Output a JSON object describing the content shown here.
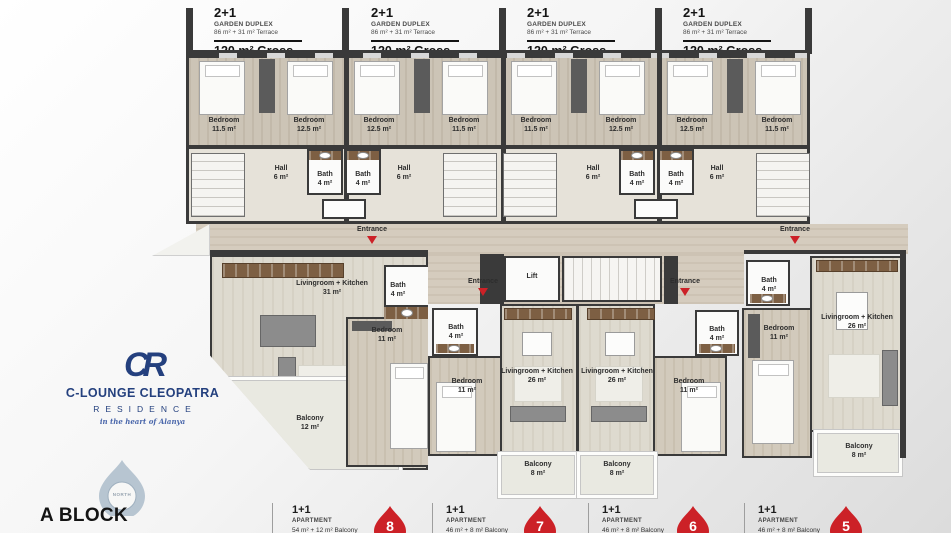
{
  "colors": {
    "red": "#cc2127",
    "blue": "#24407e",
    "wall": "#3a3a3a"
  },
  "headers": [
    {
      "type": "2+1",
      "category": "GARDEN DUPLEX",
      "area": "86 m² + 31 m² Terrace",
      "gross": "120 m² Gross"
    },
    {
      "type": "2+1",
      "category": "GARDEN DUPLEX",
      "area": "86 m² + 31 m² Terrace",
      "gross": "120 m² Gross"
    },
    {
      "type": "2+1",
      "category": "GARDEN DUPLEX",
      "area": "86 m² + 31 m² Terrace",
      "gross": "120 m² Gross"
    },
    {
      "type": "2+1",
      "category": "GARDEN DUPLEX",
      "area": "86 m² + 31 m² Terrace",
      "gross": "120 m² Gross"
    }
  ],
  "upper": {
    "bedrooms": [
      {
        "name": "Bedroom",
        "area": "11.5 m²"
      },
      {
        "name": "Bedroom",
        "area": "12.5 m²"
      },
      {
        "name": "Bedroom",
        "area": "12.5 m²"
      },
      {
        "name": "Bedroom",
        "area": "11.5 m²"
      },
      {
        "name": "Bedroom",
        "area": "11.5 m²"
      },
      {
        "name": "Bedroom",
        "area": "12.5 m²"
      },
      {
        "name": "Bedroom",
        "area": "12.5 m²"
      },
      {
        "name": "Bedroom",
        "area": "11.5 m²"
      }
    ],
    "halls": [
      {
        "name": "Hall",
        "area": "6 m²"
      },
      {
        "name": "Hall",
        "area": "6 m²"
      },
      {
        "name": "Hall",
        "area": "6 m²"
      },
      {
        "name": "Hall",
        "area": "6 m²"
      }
    ],
    "baths": [
      {
        "name": "Bath",
        "area": "4 m²"
      },
      {
        "name": "Bath",
        "area": "4 m²"
      },
      {
        "name": "Bath",
        "area": "4 m²"
      },
      {
        "name": "Bath",
        "area": "4 m²"
      }
    ]
  },
  "lower": {
    "lift": "Lift",
    "entrance": "Entrance",
    "units": [
      {
        "living_name": "Livingroom + Kitchen",
        "living_area": "31 m²",
        "bedroom_name": "Bedroom",
        "bedroom_area": "11 m²",
        "bath_name": "Bath",
        "bath_area": "4 m²",
        "balcony_name": "Balcony",
        "balcony_area": "12 m²"
      },
      {
        "living_name": "Livingroom + Kitchen",
        "living_area": "26 m²",
        "bedroom_name": "Bedroom",
        "bedroom_area": "11 m²",
        "bath_name": "Bath",
        "bath_area": "4 m²",
        "balcony_name": "Balcony",
        "balcony_area": "8 m²"
      },
      {
        "living_name": "Livingroom + Kitchen",
        "living_area": "26 m²",
        "bedroom_name": "Bedroom",
        "bedroom_area": "11 m²",
        "bath_name": "Bath",
        "bath_area": "4 m²",
        "balcony_name": "Balcony",
        "balcony_area": "8 m²"
      },
      {
        "living_name": "Livingroom + Kitchen",
        "living_area": "26 m²",
        "bedroom_name": "Bedroom",
        "bedroom_area": "11 m²",
        "bath_name": "Bath",
        "bath_area": "4 m²",
        "balcony_name": "Balcony",
        "balcony_area": "8 m²"
      }
    ]
  },
  "footer": {
    "items": [
      {
        "type": "1+1",
        "category": "APARTMENT",
        "detail": "54 m² + 12 m² Balcony",
        "badge": "8"
      },
      {
        "type": "1+1",
        "category": "APARTMENT",
        "detail": "46 m² + 8 m² Balcony",
        "badge": "7"
      },
      {
        "type": "1+1",
        "category": "APARTMENT",
        "detail": "46 m² + 8 m² Balcony",
        "badge": "6"
      },
      {
        "type": "1+1",
        "category": "APARTMENT",
        "detail": "46 m² + 8 m² Balcony",
        "badge": "5"
      }
    ]
  },
  "brand": {
    "monogram": "CR",
    "name": "C-LOUNGE CLEOPATRA",
    "line2": "RESIDENCE",
    "tagline": "in the heart of Alanya"
  },
  "block_label": "A BLOCK",
  "north_label": "NORTH"
}
